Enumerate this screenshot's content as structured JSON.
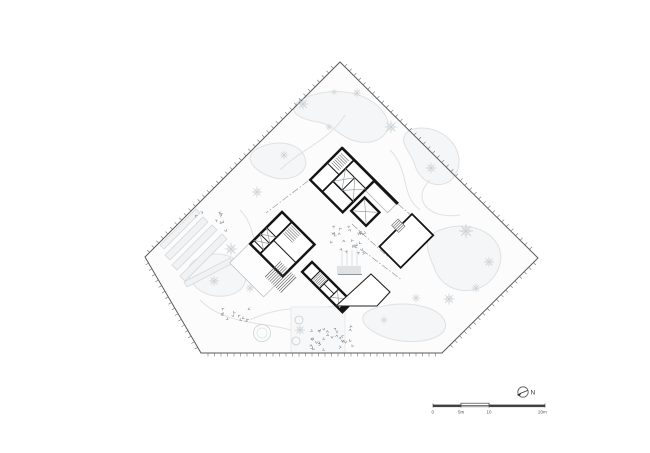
{
  "colors": {
    "ink": "#141414",
    "boundary": "#5a5a5a",
    "tick": "#6a6a6a",
    "landscape_stroke": "#dfe1e2",
    "landscape_fill": "#f5f6f7",
    "site_fill": "#fcfcfd",
    "tree": "#ccd1d4",
    "shrub": "#84898c",
    "detail_gray": "#888888",
    "stair_gray": "#555555",
    "scalebar_ink": "#3f3f3f",
    "label_ink": "#555555"
  },
  "scalebar": {
    "labels": [
      "0",
      "5m",
      "10",
      "20m"
    ]
  },
  "north": {
    "label": "N"
  }
}
